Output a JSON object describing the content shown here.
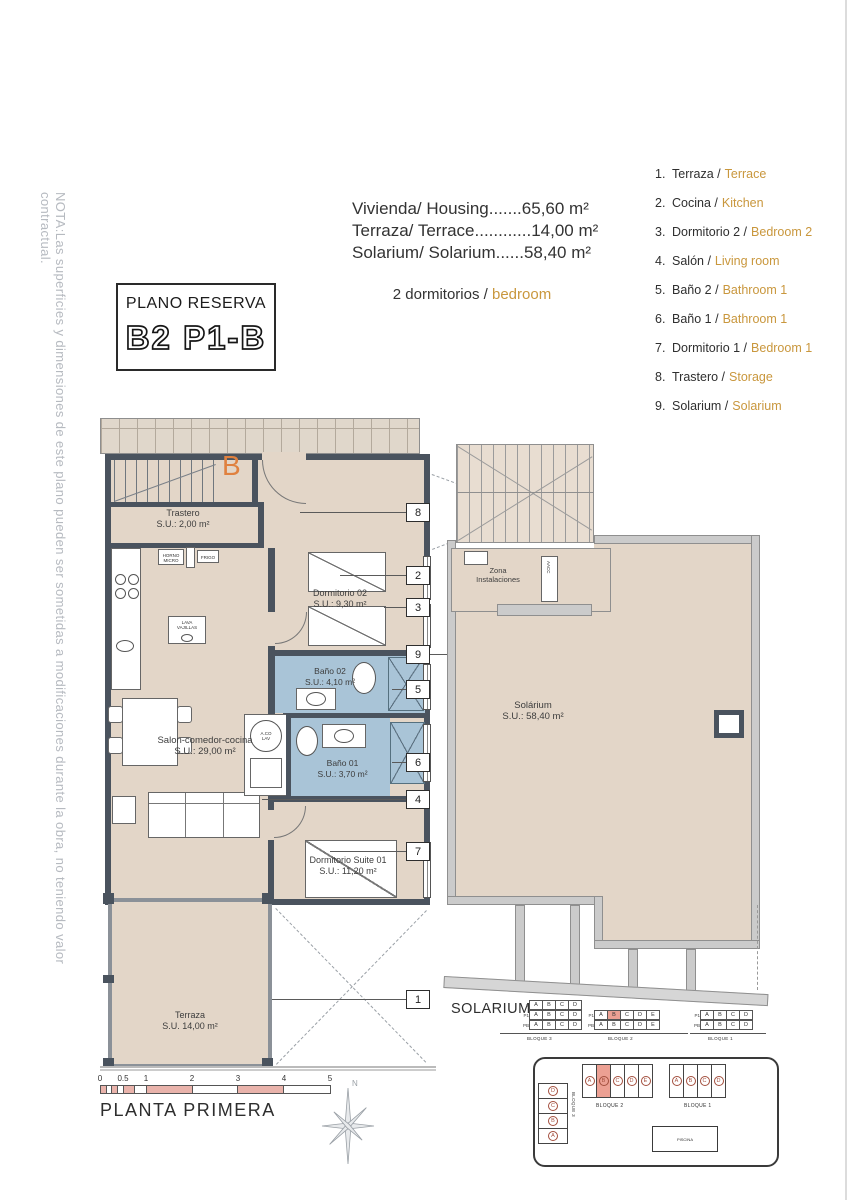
{
  "note": "NOTA:Las superficies y dimensiones de este plano pueden ser sometidas a modificaciones durante la obra, no teniendo valor contractual.",
  "title_box": {
    "line1": "PLANO RESERVA",
    "line2": "B2 P1-B"
  },
  "housing": {
    "lines": [
      "Vivienda/ Housing.......65,60 m²",
      "Terraza/ Terrace............14,00 m²",
      "Solarium/ Solarium......58,40 m²"
    ],
    "bedrooms_es": "2 dormitorios /",
    "bedrooms_en": "bedroom"
  },
  "legend": {
    "items": [
      {
        "num": "1.",
        "es": "Terraza /",
        "en": "Terrace"
      },
      {
        "num": "2.",
        "es": "Cocina /",
        "en": "Kitchen"
      },
      {
        "num": "3.",
        "es": "Dormitorio 2 /",
        "en": "Bedroom 2"
      },
      {
        "num": "4.",
        "es": "Salón /",
        "en": "Living room"
      },
      {
        "num": "5.",
        "es": "Baño 2 /",
        "en": "Bathroom 1"
      },
      {
        "num": "6.",
        "es": "Baño 1 /",
        "en": "Bathroom 1"
      },
      {
        "num": "7.",
        "es": "Dormitorio 1 /",
        "en": "Bedroom 1"
      },
      {
        "num": "8.",
        "es": "Trastero /",
        "en": "Storage"
      },
      {
        "num": "9.",
        "es": "Solarium /",
        "en": "Solarium"
      }
    ]
  },
  "plan": {
    "entry_letter": "B",
    "rooms": {
      "trastero": {
        "name": "Trastero",
        "area": "S.U.: 2,00 m²"
      },
      "dormitorio02": {
        "name": "Dormitorio 02",
        "area": "S.U.: 9,30 m²"
      },
      "bano02": {
        "name": "Baño 02",
        "area": "S.U.: 4,10 m²"
      },
      "bano01": {
        "name": "Baño 01",
        "area": "S.U.: 3,70 m²"
      },
      "salon": {
        "name": "Salon-comedor-cocina",
        "area": "S.U.: 29,00 m²"
      },
      "suite": {
        "name": "Dormitorio Suite 01",
        "area": "S.U.: 11,20 m²"
      },
      "terraza": {
        "name": "Terraza",
        "area": "S.U. 14,00 m²"
      },
      "solarium": {
        "name": "Solárium",
        "area": "S.U.: 58,40 m²"
      },
      "zona": {
        "name": "Zona",
        "name2": "Instalaciones"
      }
    },
    "appliances": {
      "horno_l1": "HORNO",
      "horno_l2": "MICRO",
      "frigo": "FRIGO",
      "lava_l1": "LAVA",
      "lava_l2": "VAJILLAS",
      "aco_l1": "A.CO",
      "aco_l2": "LAV",
      "aacc": "AACC"
    },
    "callouts": [
      "8",
      "2",
      "3",
      "9",
      "5",
      "6",
      "4",
      "7",
      "1"
    ]
  },
  "solarium_key": {
    "label": "SOLARIUM:",
    "blocks": [
      {
        "name": "BLOQUE 3",
        "rows": [
          {
            "label": "S",
            "cells": [
              "A",
              "B",
              "C",
              "D"
            ]
          },
          {
            "label": "P1",
            "cells": [
              "A",
              "B",
              "C",
              "D"
            ]
          },
          {
            "label": "PB",
            "cells": [
              "A",
              "B",
              "C",
              "D"
            ]
          }
        ],
        "highlight": null
      },
      {
        "name": "BLOQUE 2",
        "rows": [
          {
            "label": "P1",
            "cells": [
              "A",
              "B",
              "C",
              "D",
              "E"
            ]
          },
          {
            "label": "PB",
            "cells": [
              "A",
              "B",
              "C",
              "D",
              "E"
            ]
          }
        ],
        "highlight": {
          "row": 0,
          "cell": 1
        }
      },
      {
        "name": "BLOQUE 1",
        "rows": [
          {
            "label": "P1",
            "cells": [
              "A",
              "B",
              "C",
              "D"
            ]
          },
          {
            "label": "PB",
            "cells": [
              "A",
              "B",
              "C",
              "D"
            ]
          }
        ],
        "highlight": null
      }
    ]
  },
  "site_plan": {
    "bloque2": {
      "name": "BLOQUE 2",
      "units": [
        "A",
        "B",
        "C",
        "D",
        "E"
      ],
      "highlight": 1
    },
    "bloque1": {
      "name": "BLOQUE 1",
      "units": [
        "A",
        "B",
        "C",
        "D"
      ],
      "highlight": null
    },
    "bloque3": {
      "name": "BLOQUE 3",
      "units": [
        "D",
        "C",
        "B",
        "A"
      ],
      "highlight": null
    },
    "piscina": "PISCINA"
  },
  "footer": {
    "scale_ticks": [
      "0",
      "0.5",
      "1",
      "2",
      "3",
      "4",
      "5"
    ],
    "plan_name": "PLANTA PRIMERA",
    "compass": "N"
  },
  "colors": {
    "highlight": "#ECA093",
    "bath_blue": "#A9C4D7",
    "floor_tan": "#E3D6C8",
    "wall_dark": "#4A535E",
    "accent_orange": "#C9973D",
    "entry_orange": "#E0813F",
    "scale_salmon": "#E9B3AB"
  }
}
